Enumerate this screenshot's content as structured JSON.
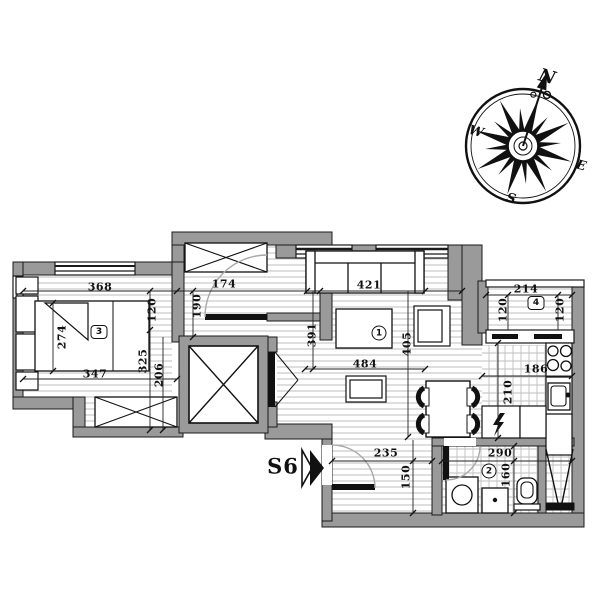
{
  "meta": {
    "type": "architectural floor plan",
    "unit_label": "S6"
  },
  "compass": {
    "north": "N",
    "east": "E",
    "south": "S",
    "west": "W"
  },
  "rooms": {
    "living": {
      "badge": "1"
    },
    "bathroom": {
      "badge": "2"
    },
    "bedroom": {
      "badge": "3"
    },
    "balcony": {
      "badge": "4"
    }
  },
  "dims": {
    "bedroom_width_top": "368",
    "bedroom_strip_120": "120",
    "hall_depth_190": "190",
    "hall_width_174": "174",
    "bed_length_274": "274",
    "bedroom_strip_325": "325",
    "bedroom_strip_206": "206",
    "bedroom_width_bottom": "347",
    "living_width_top": "421",
    "living_depth_left": "391",
    "living_depth_right": "405",
    "living_width_bottom": "484",
    "balcony_width": "214",
    "balcony_depth_left": "120",
    "balcony_depth_right": "120",
    "kitchen_width": "186",
    "kitchen_depth": "210",
    "entry_width_235": "235",
    "entry_depth_150": "150",
    "bathroom_width": "290",
    "bathroom_depth": "160"
  },
  "colors": {
    "wall_fill": "#9a9a9a",
    "line": "#1a1a1a",
    "hatch": "#bdbdbd",
    "door_arc": "#a8a8a8"
  }
}
